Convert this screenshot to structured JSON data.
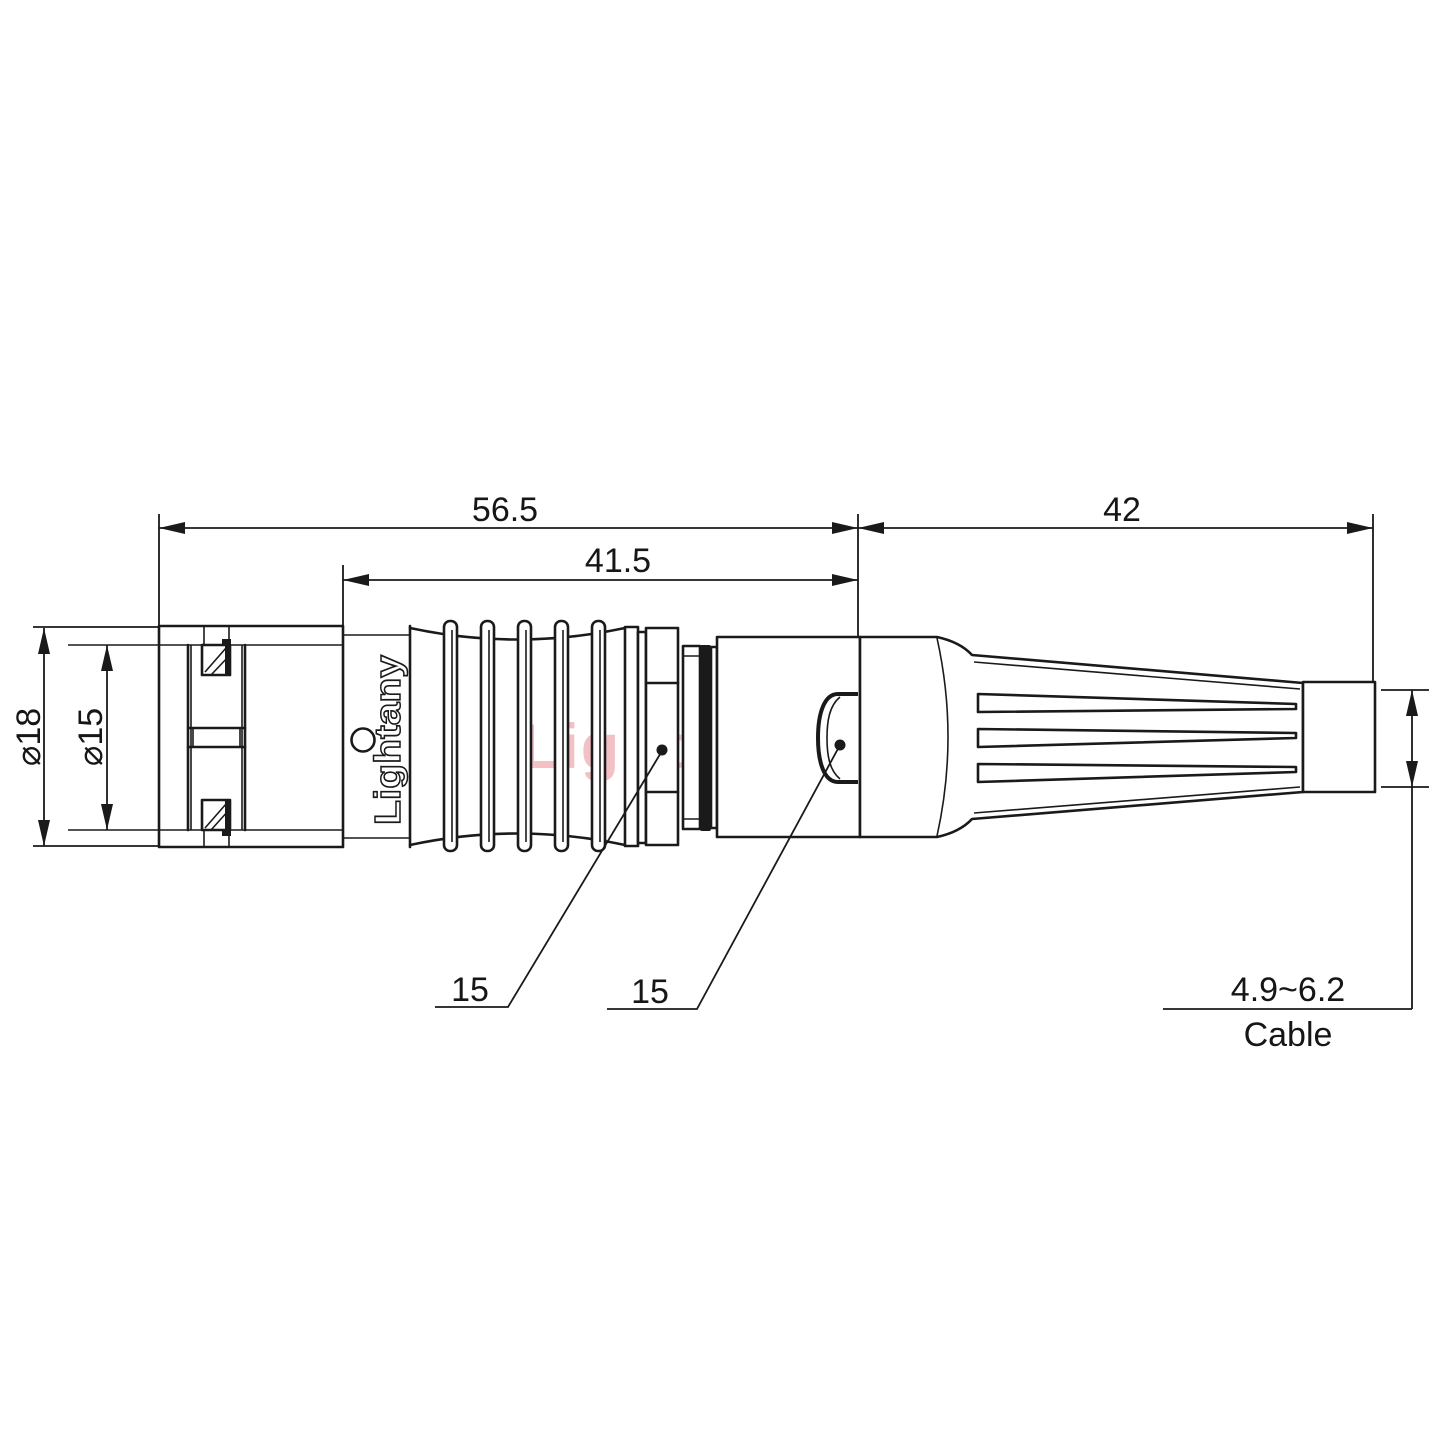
{
  "drawing": {
    "brand_label": "Lightany",
    "watermark_text": "Lightany",
    "dimensions": {
      "overall_length": "56.5",
      "front_length": "41.5",
      "rear_length": "42",
      "outer_diameter": "⌀18",
      "inner_diameter": "⌀15",
      "nut_callout": "15",
      "latch_callout": "15",
      "cable_diameter_range": "4.9~6.2",
      "cable_label": "Cable"
    },
    "colors": {
      "line": "#1a1a1a",
      "watermark_pink": "#f1b6bc",
      "background": "#ffffff"
    }
  }
}
